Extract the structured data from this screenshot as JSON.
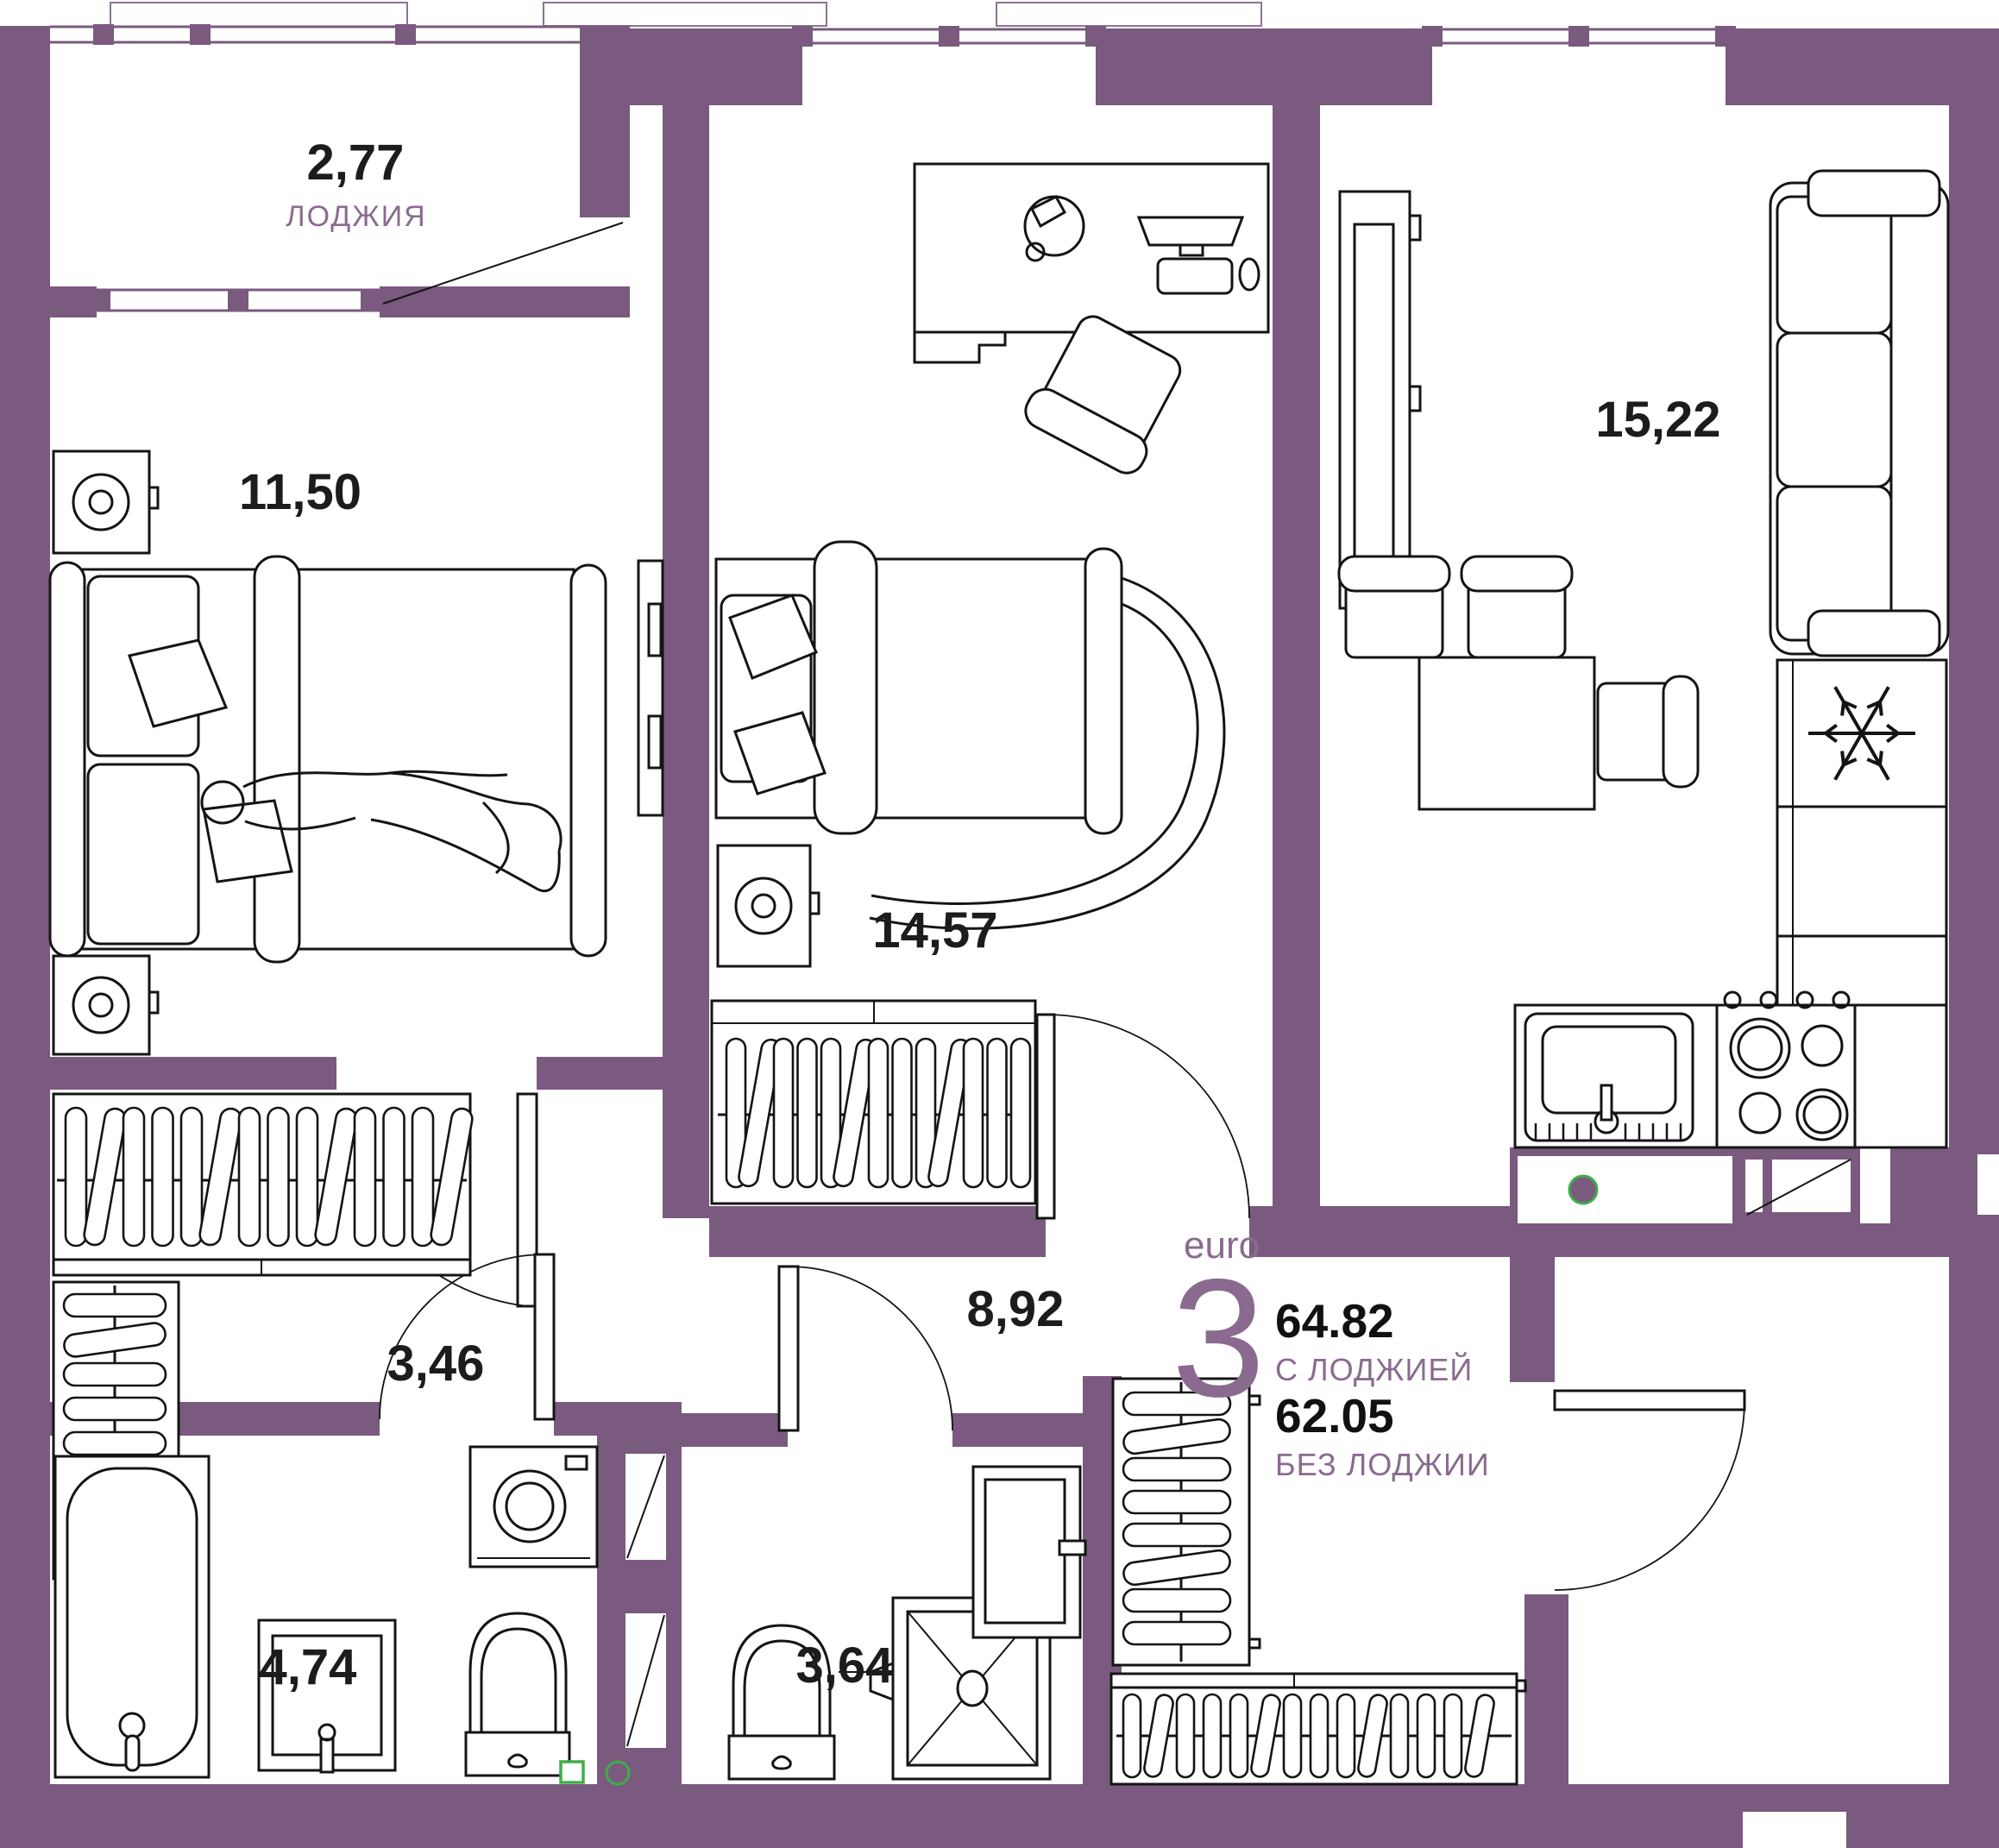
{
  "plan_info": {
    "type_label": "euro",
    "type_number": "3",
    "area_with_loggia": "64.82",
    "with_loggia_caption": "С ЛОДЖИЕЙ",
    "area_without_loggia": "62.05",
    "without_loggia_caption": "БЕЗ ЛОДЖИИ"
  },
  "rooms": {
    "loggia": {
      "area": "2,77",
      "name": "ЛОДЖИЯ"
    },
    "bedroom1": {
      "area": "11,50"
    },
    "bedroom2": {
      "area": "14,57"
    },
    "living": {
      "area": "15,22"
    },
    "hall": {
      "area": "3,46"
    },
    "corridor": {
      "area": "8,92"
    },
    "bathroom": {
      "area": "4,74"
    },
    "showerwc": {
      "area": "3,64"
    }
  },
  "colors": {
    "wall": "#7a5a7e",
    "label_purple": "#8a6b8f",
    "number_black": "#1c1c1c",
    "accent_green": "#3fae49",
    "slab_outline": "#8d7394"
  },
  "icons": {
    "fridge": "snowflake-icon",
    "vent": "vent-dot-icon"
  }
}
